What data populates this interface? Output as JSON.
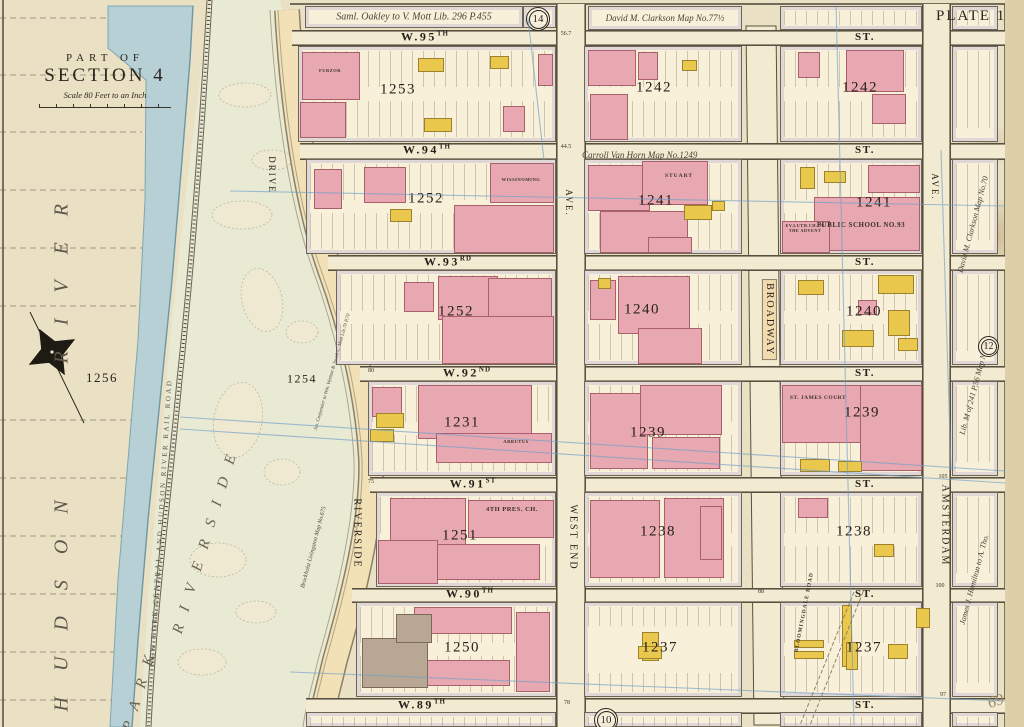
{
  "sheet": {
    "plate_title": "PLATE 11.",
    "part_of": "PART OF",
    "section": "SECTION 4",
    "scale": "Scale 80 Feet to an Inch",
    "handwritten_mark": "69"
  },
  "refs": {
    "top": "14",
    "right": "12",
    "bottom": "10"
  },
  "notes": {
    "oakley": "Saml. Oakley to V. Mott   Lib. 296 P.455",
    "clarkson_top": "David M. Clarkson Map No.77½",
    "van_horn": "Carroll Van Horn  Map No.1249",
    "clarkson_right": "David M. Clarkson Map No.70",
    "lib_right": "Lib. M of 241 P.56 Map No.46",
    "hamilton": "James J. Hamilton to A. Tho.",
    "carpentier": "Jas. Carpentier to Wm. Wyman & Jacob C. Mott  Lib.70 P.70",
    "livingston": "Brockholst Livingston  Map No.675"
  },
  "geo": {
    "river_word1": "HUDSON",
    "river_word2": "RIVER",
    "park_word1": "RIVERSIDE",
    "park_word2": "PARK",
    "railroad": "NEW YORK CENTRAL AND HUDSON RIVER RAIL ROAD",
    "park_block_numbers": [
      "1256",
      "1254"
    ]
  },
  "streets": {
    "horizontal": [
      {
        "name": "W.95",
        "sup": "TH",
        "suffix": "ST."
      },
      {
        "name": "W.94",
        "sup": "TH",
        "suffix": "ST."
      },
      {
        "name": "W.93",
        "sup": "RD",
        "suffix": "ST."
      },
      {
        "name": "W.92",
        "sup": "ND",
        "suffix": "ST."
      },
      {
        "name": "W.91",
        "sup": "ST",
        "suffix": "ST."
      },
      {
        "name": "W.90",
        "sup": "TH",
        "suffix": "ST."
      },
      {
        "name": "W.89",
        "sup": "TH",
        "suffix": "ST."
      }
    ],
    "riverside_drive": {
      "top": "DRIVE",
      "bottom": "RIVERSIDE"
    },
    "west_end": {
      "ave": "AVE.",
      "name": "WEST END"
    },
    "broadway": "BROADWAY",
    "amsterdam": {
      "ave": "AVE.",
      "name": "AMSTERDAM"
    }
  },
  "blocks": [
    {
      "number": "1253",
      "landmark": "FURZOR"
    },
    {
      "number": "1242"
    },
    {
      "number": "1242"
    },
    {
      "number": "1252",
      "landmark": "WISSINOMING"
    },
    {
      "number": "1241",
      "landmark": "STUART"
    },
    {
      "number": "1241",
      "landmark": "PUBLIC SCHOOL NO.93",
      "landmark2": "EV.LUTH.CH.OF THE ADVENT"
    },
    {
      "number": "1252"
    },
    {
      "number": "1240"
    },
    {
      "number": "1240"
    },
    {
      "number": "1231",
      "landmark": "ARBUTUS"
    },
    {
      "number": "1239"
    },
    {
      "number": "1239",
      "landmark": "ST. JAMES COURT"
    },
    {
      "number": "1251",
      "landmark": "4TH PRES. CH."
    },
    {
      "number": "1238"
    },
    {
      "number": "1238"
    },
    {
      "number": "1250"
    },
    {
      "number": "1237"
    },
    {
      "number": "1237",
      "landmark": "BLOOMINGDALE ROAD"
    }
  ],
  "corner_numbers": [
    {
      "t": "56.7",
      "x": 566,
      "y": 34
    },
    {
      "t": "44.5",
      "x": 566,
      "y": 147
    },
    {
      "t": "80",
      "x": 371,
      "y": 371
    },
    {
      "t": "75",
      "x": 371,
      "y": 482
    },
    {
      "t": "78",
      "x": 567,
      "y": 703
    },
    {
      "t": "88",
      "x": 761,
      "y": 592
    },
    {
      "t": "97",
      "x": 943,
      "y": 695
    },
    {
      "t": "100",
      "x": 940,
      "y": 586
    },
    {
      "t": "105",
      "x": 943,
      "y": 477
    }
  ]
}
